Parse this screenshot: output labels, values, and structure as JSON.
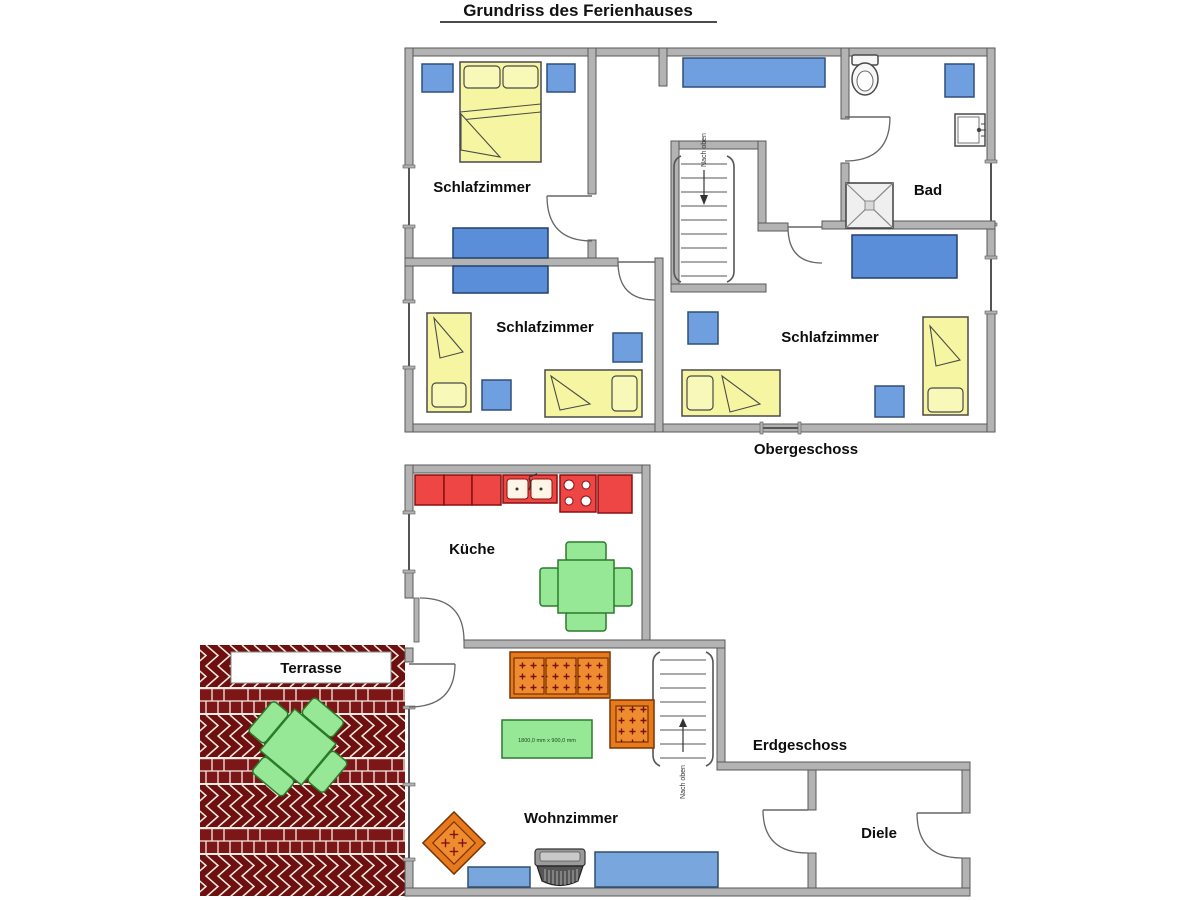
{
  "title": "Grundriss des Ferienhauses",
  "upper_floor": {
    "label": "Obergeschoss",
    "bedroom_top_left": "Schlafzimmer",
    "bedroom_bottom_left": "Schlafzimmer",
    "bedroom_right": "Schlafzimmer",
    "bathroom": "Bad",
    "stairs_label": "Nach oben"
  },
  "ground_floor": {
    "label": "Erdgeschoss",
    "kitchen": "Küche",
    "living_room": "Wohnzimmer",
    "hallway": "Diele",
    "terrace": "Terrasse",
    "stairs_label": "Nach oben",
    "coffee_table_dimensions": "1800,0 mm x 900,0 mm"
  },
  "colors": {
    "wall_fill": "#b3b3b3",
    "wall_stroke": "#595959",
    "furniture_blue": "#6f9fdf",
    "bed_yellow": "#f6f6a2",
    "kitchen_red": "#ee4545",
    "table_green": "#96e896",
    "sofa_orange": "#e87a1e",
    "terrace_brick": "#6f1010"
  }
}
